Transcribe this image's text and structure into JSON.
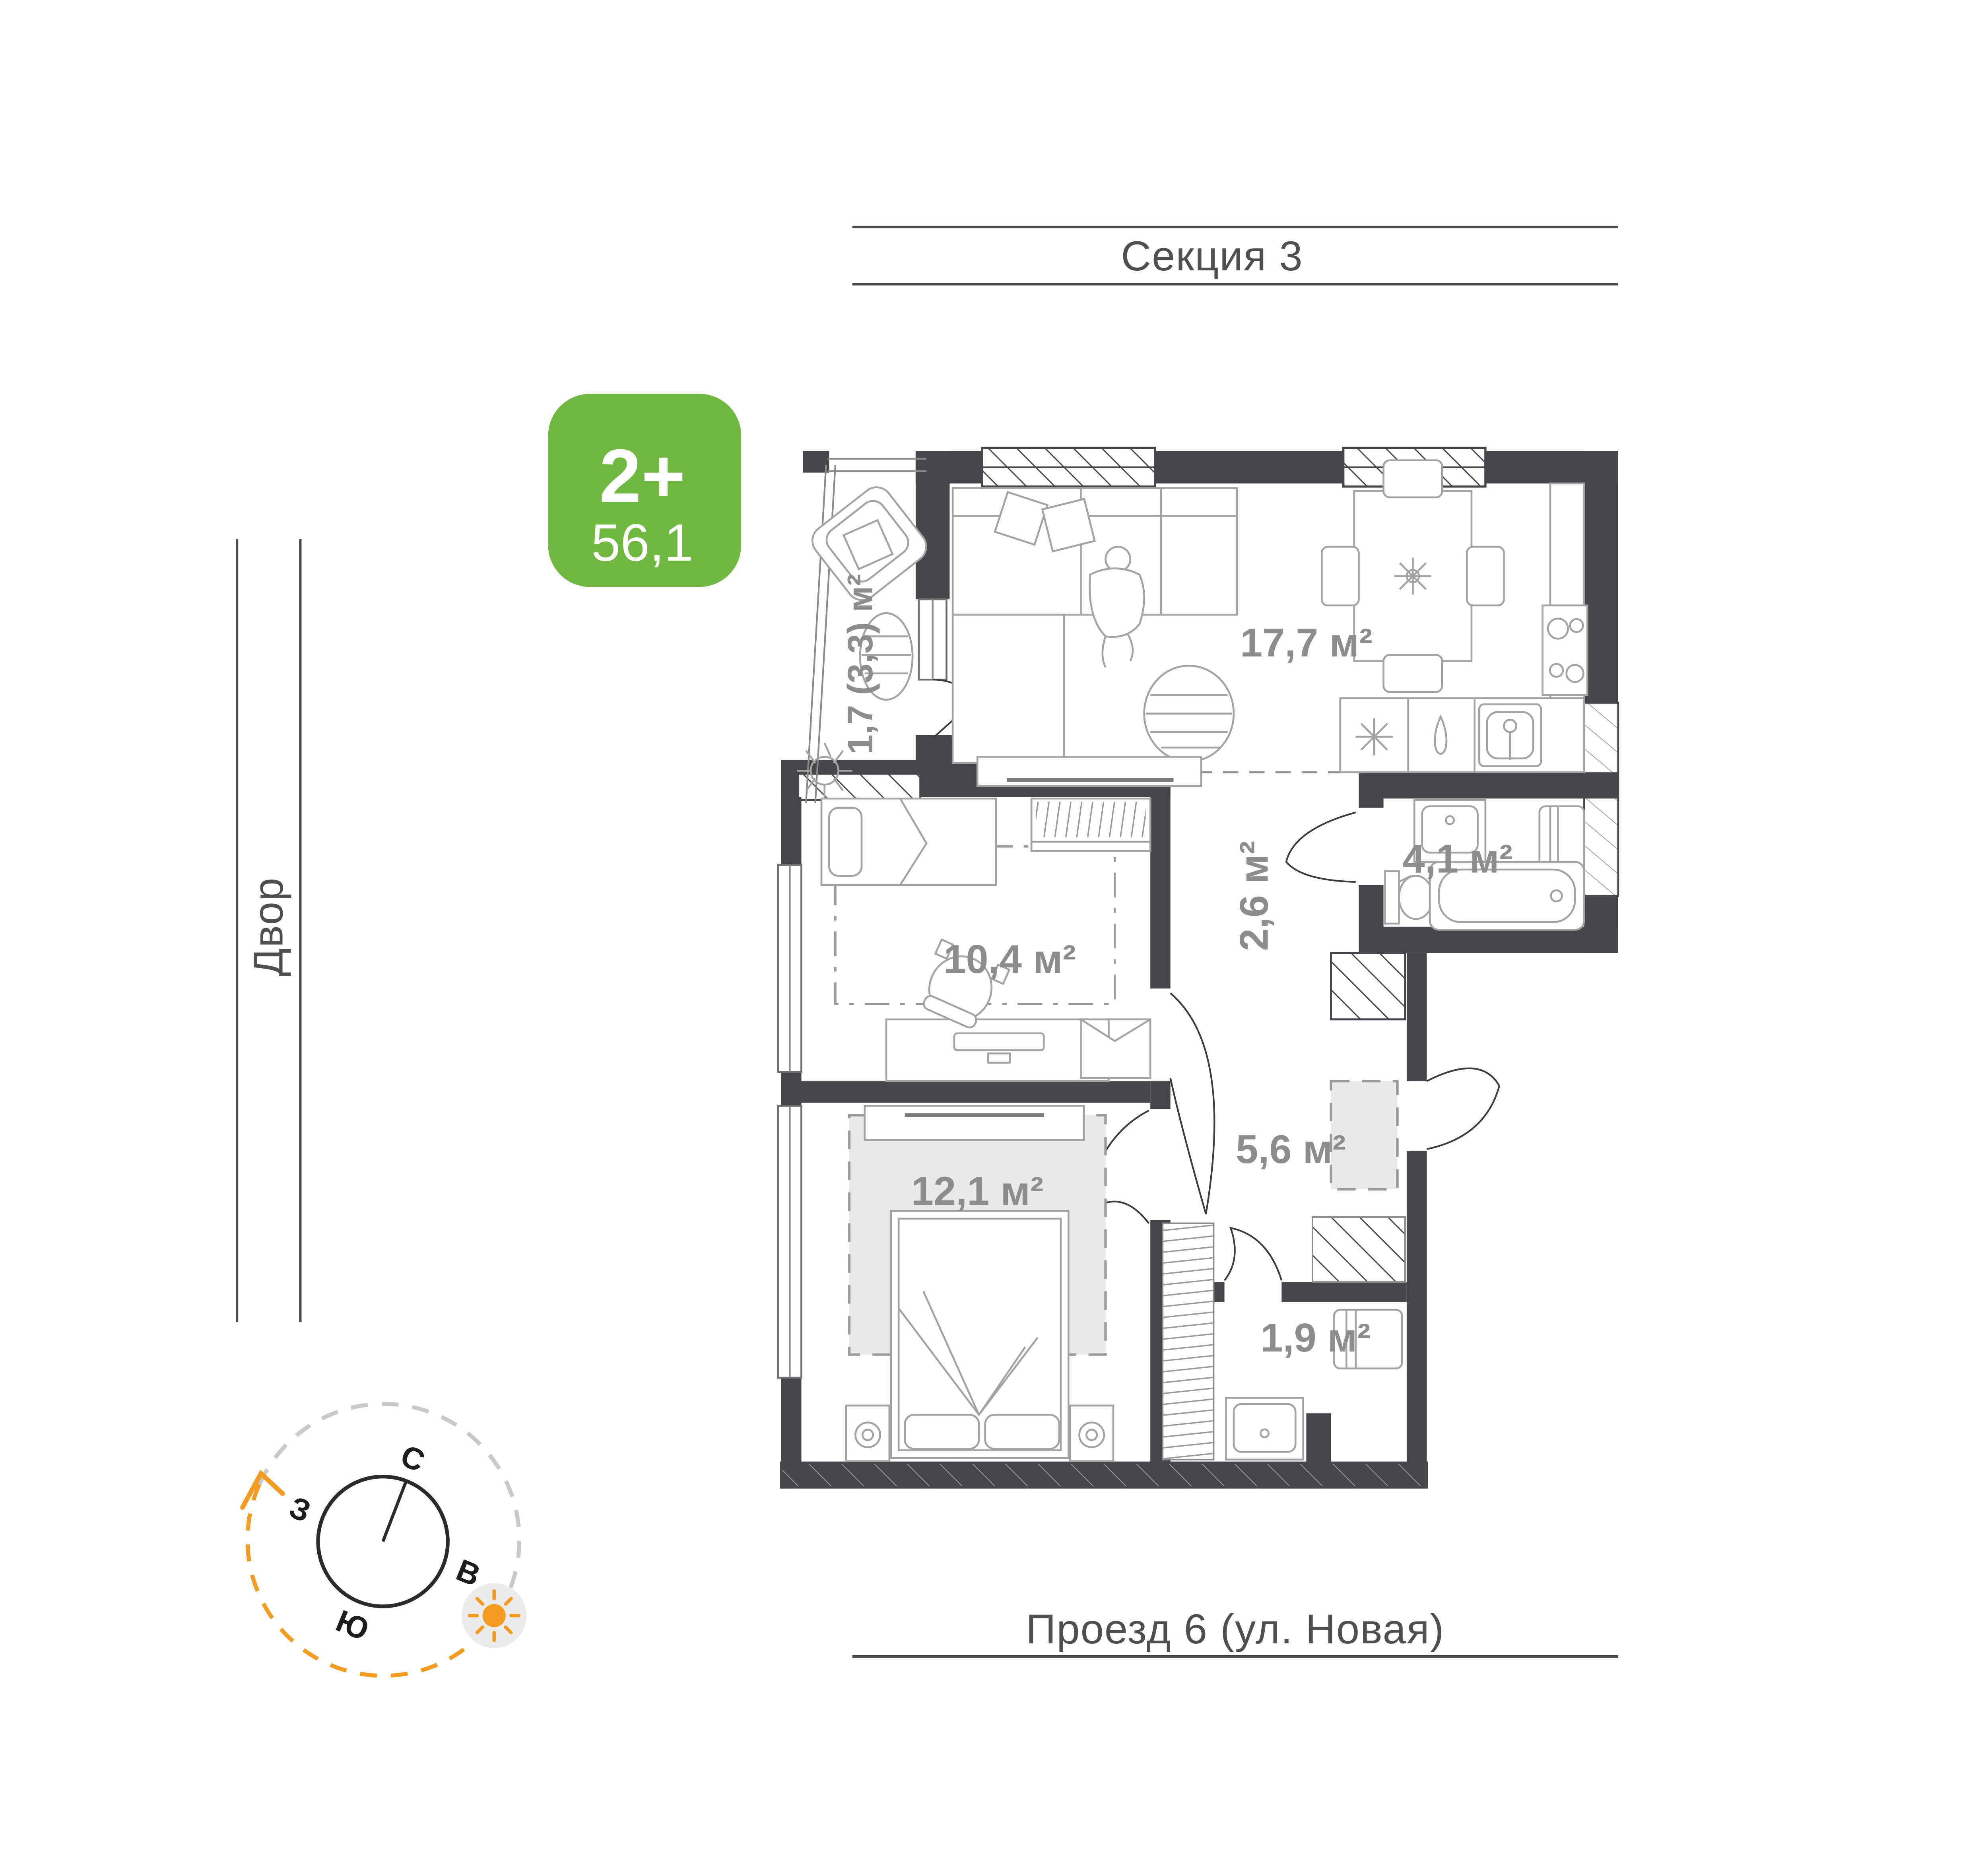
{
  "header": {
    "section": "Секция 3"
  },
  "streets": {
    "left": "Двор",
    "right": "Проезд 8 (ул. Новая)",
    "bottom": "Проезд 6 (ул. Новая)"
  },
  "badge": {
    "rooms": "2+",
    "area": "56,1"
  },
  "plan": {
    "rooms": {
      "living_kitchen": "17,7 м²",
      "balcony": "1,7 (3,3) м²",
      "hall": "2,6 м²",
      "bathroom": "4,1 м²",
      "bedroom_small": "10,4 м²",
      "corridor": "5,6 м²",
      "bedroom_master": "12,1 м²",
      "laundry": "1,9 м²"
    }
  },
  "compass": {
    "north": "С",
    "east": "В",
    "south": "Ю",
    "west": "З"
  },
  "colors": {
    "badge_green": "#71B840",
    "wall_dark": "#46464A",
    "room_label_gray": "#8D8D8D",
    "street_gray": "#4F4F52",
    "accent_orange": "#F39C1F"
  }
}
